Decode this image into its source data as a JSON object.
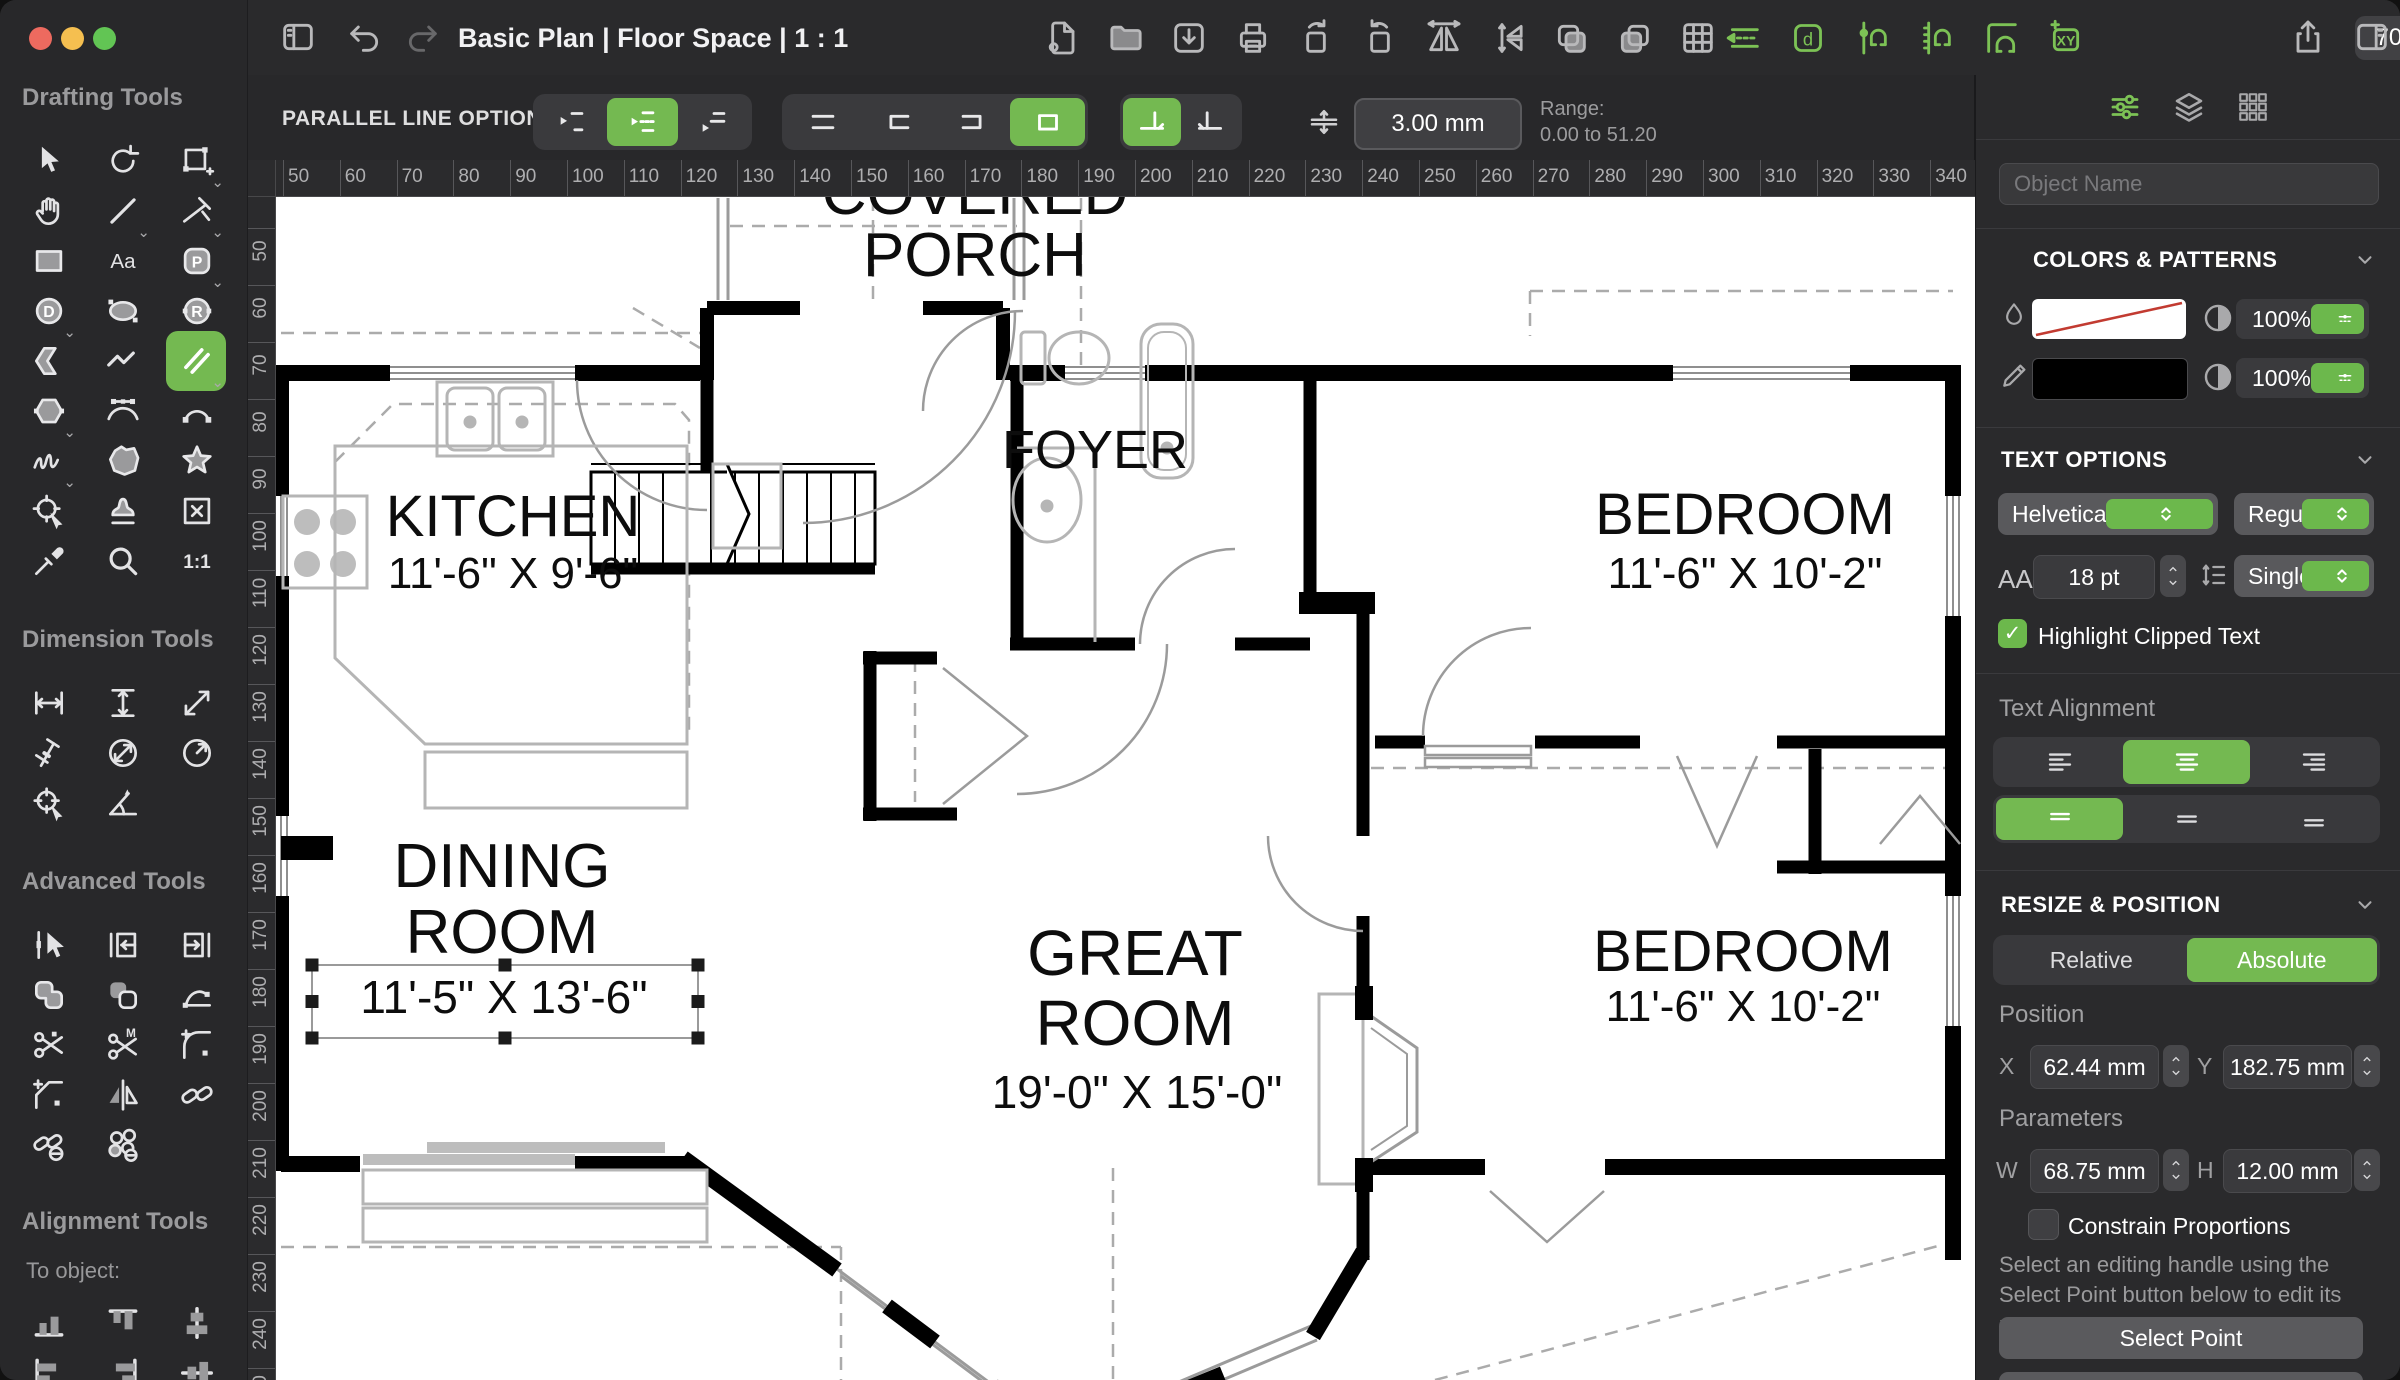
{
  "titlebar": {
    "title": "Basic Plan | Floor Space | 1 : 1",
    "zoom_value": "70.0%",
    "left_icons": [
      "sidebar-toggle",
      "undo",
      "redo"
    ],
    "doc_icons": [
      "new-document",
      "open-folder",
      "import",
      "print",
      "rotate-left",
      "rotate-right",
      "flip-horizontal",
      "flip-vertical",
      "copy",
      "duplicate",
      "table"
    ],
    "snap_icons": [
      "snap-parallel",
      "snap-text",
      "snap-vertical",
      "snap-horizontal",
      "snap-corner",
      "snap-xy"
    ],
    "right_icons": [
      "share",
      "panel-right"
    ]
  },
  "options_bar": {
    "label": "PARALLEL LINE OPTIONS",
    "groups": [
      {
        "name": "offset",
        "buttons": [
          {
            "icon": "offset-top",
            "selected": false
          },
          {
            "icon": "offset-center",
            "selected": true
          },
          {
            "icon": "offset-bottom",
            "selected": false
          }
        ]
      },
      {
        "name": "ends",
        "buttons": [
          {
            "icon": "ends-open",
            "selected": false
          },
          {
            "icon": "ends-left",
            "selected": false
          },
          {
            "icon": "ends-right",
            "selected": false
          },
          {
            "icon": "ends-closed",
            "selected": true
          }
        ]
      },
      {
        "name": "join",
        "buttons": [
          {
            "icon": "join-left",
            "selected": true
          },
          {
            "icon": "join-right",
            "selected": false
          }
        ]
      }
    ],
    "spacing_value": "3.00 mm",
    "range_label": "Range:",
    "range_value": "0.00 to 51.20"
  },
  "sidebar": {
    "sections": [
      {
        "title": "Drafting Tools",
        "tools": [
          {
            "icon": "select"
          },
          {
            "icon": "rotate"
          },
          {
            "icon": "crop",
            "chevron": true
          },
          {
            "icon": "pan"
          },
          {
            "icon": "line",
            "chevron": true
          },
          {
            "icon": "trim",
            "chevron": true
          },
          {
            "icon": "rectangle"
          },
          {
            "icon": "text"
          },
          {
            "icon": "shape-p",
            "chevron": true
          },
          {
            "icon": "circle-d",
            "chevron": true
          },
          {
            "icon": "ellipse"
          },
          {
            "icon": "circle-r",
            "chevron": true
          },
          {
            "icon": "arrow-shape"
          },
          {
            "icon": "polyline"
          },
          {
            "icon": "parallel-line",
            "selected": true,
            "chevron": true
          },
          {
            "icon": "hexagon",
            "chevron": true
          },
          {
            "icon": "bezier"
          },
          {
            "icon": "arc"
          },
          {
            "icon": "freehand",
            "chevron": true
          },
          {
            "icon": "blob"
          },
          {
            "icon": "star"
          },
          {
            "icon": "position"
          },
          {
            "icon": "stamp"
          },
          {
            "icon": "delete-box"
          },
          {
            "icon": "eyedropper"
          },
          {
            "icon": "zoom-tool"
          },
          {
            "icon": "one-to-one"
          }
        ]
      },
      {
        "title": "Dimension Tools",
        "tools": [
          {
            "icon": "dim-horizontal"
          },
          {
            "icon": "dim-vertical"
          },
          {
            "icon": "dim-diagonal"
          },
          {
            "icon": "dim-perpendicular"
          },
          {
            "icon": "dim-diameter"
          },
          {
            "icon": "dim-radius"
          },
          {
            "icon": "dim-center"
          },
          {
            "icon": "dim-angle"
          }
        ]
      },
      {
        "title": "Advanced Tools",
        "tools": [
          {
            "icon": "edit-select"
          },
          {
            "icon": "extend-left"
          },
          {
            "icon": "extend-right"
          },
          {
            "icon": "union"
          },
          {
            "icon": "subtract"
          },
          {
            "icon": "reshape"
          },
          {
            "icon": "cut"
          },
          {
            "icon": "multi-cut"
          },
          {
            "icon": "fillet"
          },
          {
            "icon": "chamfer"
          },
          {
            "icon": "mirror"
          },
          {
            "icon": "link"
          },
          {
            "icon": "unlink"
          },
          {
            "icon": "detach"
          }
        ]
      },
      {
        "title": "Alignment Tools",
        "subtitle": "To object:",
        "tools": [
          {
            "icon": "align-bottom"
          },
          {
            "icon": "align-top"
          },
          {
            "icon": "align-center-horizontal"
          },
          {
            "icon": "align-left"
          },
          {
            "icon": "align-right"
          },
          {
            "icon": "align-center-vertical"
          }
        ]
      }
    ]
  },
  "rulers": {
    "top": [
      50,
      60,
      70,
      80,
      90,
      100,
      110,
      120,
      130,
      140,
      150,
      160,
      170,
      180,
      190,
      200,
      210,
      220,
      230,
      240,
      250,
      260,
      270,
      280,
      290,
      300,
      310,
      320,
      330,
      340,
      350
    ],
    "left": [
      50,
      60,
      70,
      80,
      90,
      100,
      110,
      120,
      130,
      140,
      150,
      160,
      170,
      180,
      190,
      200,
      210,
      220,
      230,
      240,
      250
    ]
  },
  "plan": {
    "texts": {
      "covered1": "COVERED",
      "covered2": "PORCH",
      "foyer": "FOYER",
      "kitchen": "KITCHEN",
      "kitchen_dims": "11'-6\" X 9'-6\"",
      "bed1": "BEDROOM",
      "bed1_dims": "11'-6\" X 10'-2\"",
      "dining1": "DINING",
      "dining2": "ROOM",
      "dining_dims": "11'-5\" X 13'-6\"",
      "great1": "GREAT",
      "great2": "ROOM",
      "great_dims": "19'-0\" X 15'-0\"",
      "bed2": "BEDROOM",
      "bed2_dims": "11'-6\" X 10'-2\""
    }
  },
  "panel": {
    "object_name_placeholder": "Object Name",
    "colors": {
      "title": "COLORS & PATTERNS",
      "fill_opacity": "100%",
      "stroke_opacity": "100%"
    },
    "text_options": {
      "title": "TEXT OPTIONS",
      "font": "Helvetica Neue",
      "style": "Regular",
      "size_label": "AA",
      "size": "18 pt",
      "spacing": "Single",
      "highlight_label": "Highlight Clipped Text",
      "check_glyph": "✓"
    },
    "alignment": {
      "label": "Text Alignment"
    },
    "resize": {
      "title": "RESIZE & POSITION",
      "mode_options": [
        "Relative",
        "Absolute"
      ],
      "position_label": "Position",
      "x_label": "X",
      "x": "62.44 mm",
      "y_label": "Y",
      "y": "182.75 mm",
      "parameters_label": "Parameters",
      "w_label": "W",
      "w": "68.75 mm",
      "h_label": "H",
      "h": "12.00 mm",
      "constrain_label": "Constrain Proportions",
      "help": "Select an editing handle using the Select Point button below to edit its parameters.",
      "select_point": "Select Point",
      "apply": "Apply"
    }
  }
}
